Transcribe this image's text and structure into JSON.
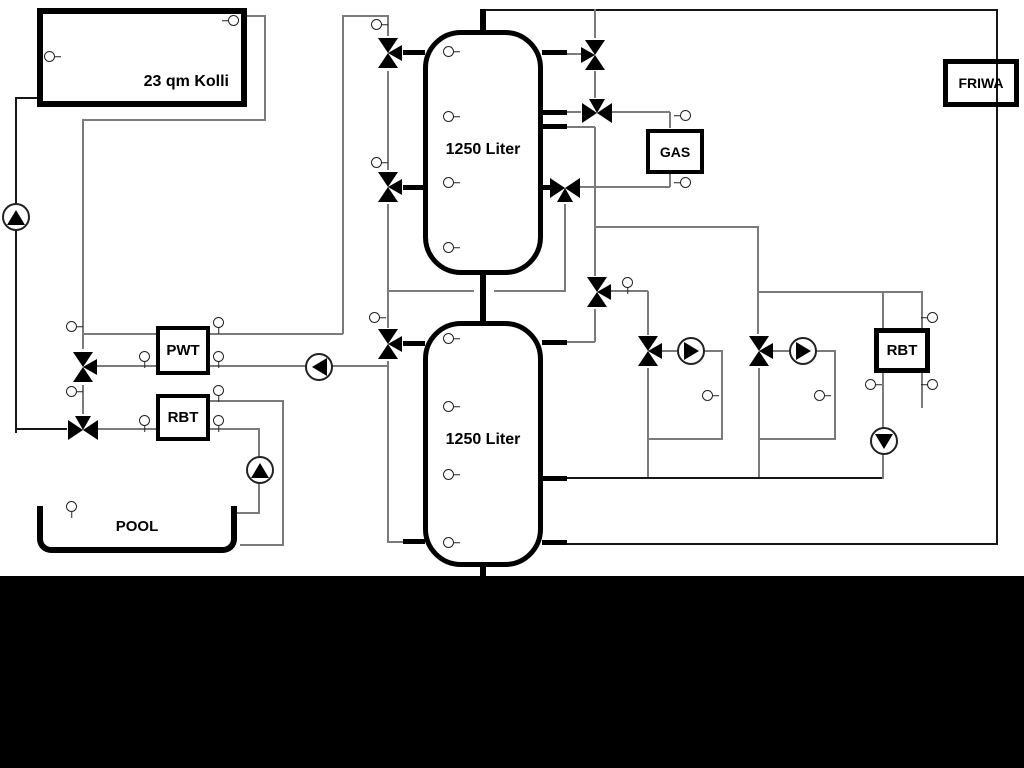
{
  "diagram": {
    "solar_collector": {
      "label": "23 qm Kolli"
    },
    "buffer_tank_upper": {
      "label": "1250 Liter"
    },
    "buffer_tank_lower": {
      "label": "1250 Liter"
    },
    "gas_boiler": {
      "label": "GAS"
    },
    "fresh_water_module": {
      "label": "FRIWA"
    },
    "pool_heat_exchanger": {
      "label": "PWT"
    },
    "pool_return_unit": {
      "label": "RBT"
    },
    "heating_return_unit": {
      "label": "RBT"
    },
    "pool": {
      "label": "POOL"
    }
  },
  "colors": {
    "background": "#ffffff",
    "footer_band": "#000000",
    "outline": "#000000",
    "pipe_gray": "#7b7b7b",
    "pipe_black": "#161616"
  }
}
